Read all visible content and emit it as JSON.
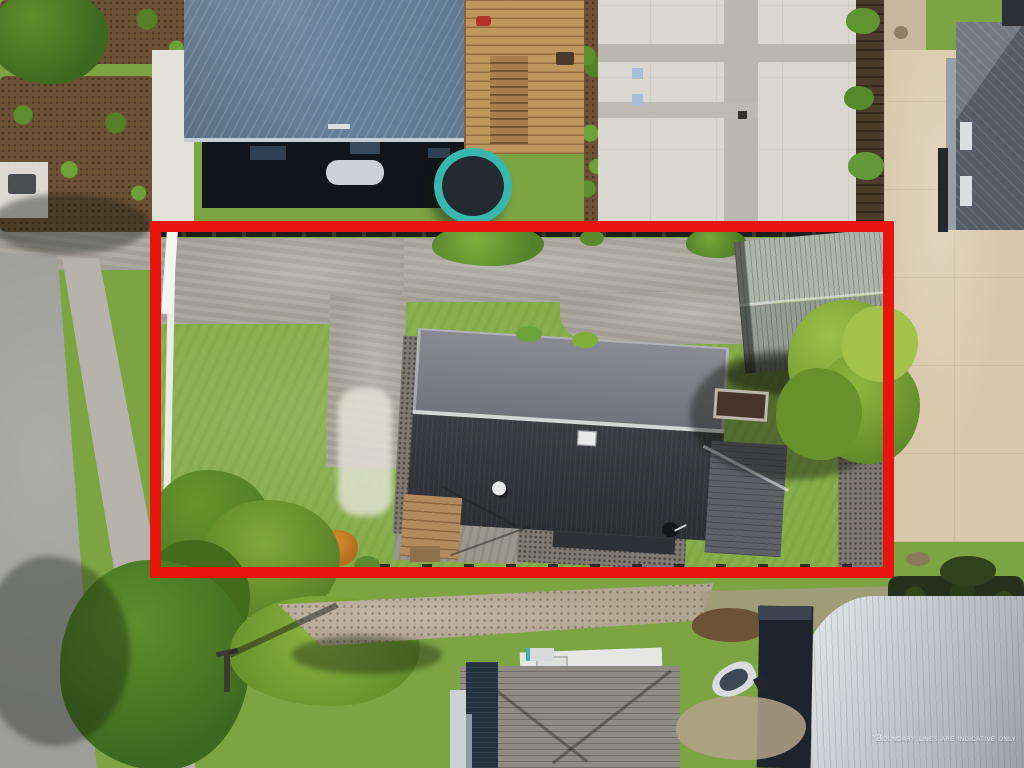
{
  "overlay": {
    "disclaimer": "*Boundary lines are indicative only",
    "boundary_color": "#e8140e"
  },
  "scene": {
    "description": "aerial drone view of a residential property outlined in red",
    "outlined_property": {
      "features": [
        "long-concrete-driveway",
        "front-lawn",
        "main-house-dark-charcoal-roof",
        "lighter-ribbed-roof-section",
        "attached-wing-shingle-roof",
        "garage-shed-grey-green-corrugated-roof",
        "large-overhanging-tree",
        "raised-garden-bed",
        "timber-deck",
        "clothesline-patio",
        "white-side-fence",
        "gravel-edging",
        "yellow-and-orange-shrubs",
        "corner-trees"
      ]
    },
    "surroundings": {
      "top": [
        "neighbour-house-blue-metal-hip-roof",
        "timber-deck-with-stairs",
        "trampoline",
        "shared-white-concrete-driveway",
        "timber-fence",
        "modern-grey-roof-house",
        "mulch-garden-beds"
      ],
      "left": [
        "street-road",
        "footpath",
        "grass-verge",
        "power-pole",
        "manhole"
      ],
      "bottom": [
        "gravel-lane",
        "mature-trees",
        "hip-roof-house-with-chimney",
        "boat-on-trailer",
        "dark-shed",
        "large-arched-barn-roof"
      ],
      "right": [
        "beige-concrete-yard",
        "dark-roof-house",
        "lawn-strip",
        "hedge-row"
      ]
    }
  },
  "palette": {
    "boundary_red": "#e8140e",
    "lawn_green_inside": "#86ad4a",
    "grass_outer": "#7da443",
    "concrete_grey": "#a8a49b",
    "driveway_white": "#d9d7d0",
    "beige_concrete": "#d8c7aa",
    "main_roof_charcoal": "#33363b",
    "main_roof_upper_grey": "#7e7d88",
    "garage_roof_grey_green": "#a3aca0",
    "neighbour_roof_blue": "#6a8099",
    "barn_roof_light_grey": "#c6cbd0",
    "trampoline_teal": "#38b7af",
    "road_asphalt": "#9e9e99",
    "tree_foliage": "#7ca336"
  }
}
